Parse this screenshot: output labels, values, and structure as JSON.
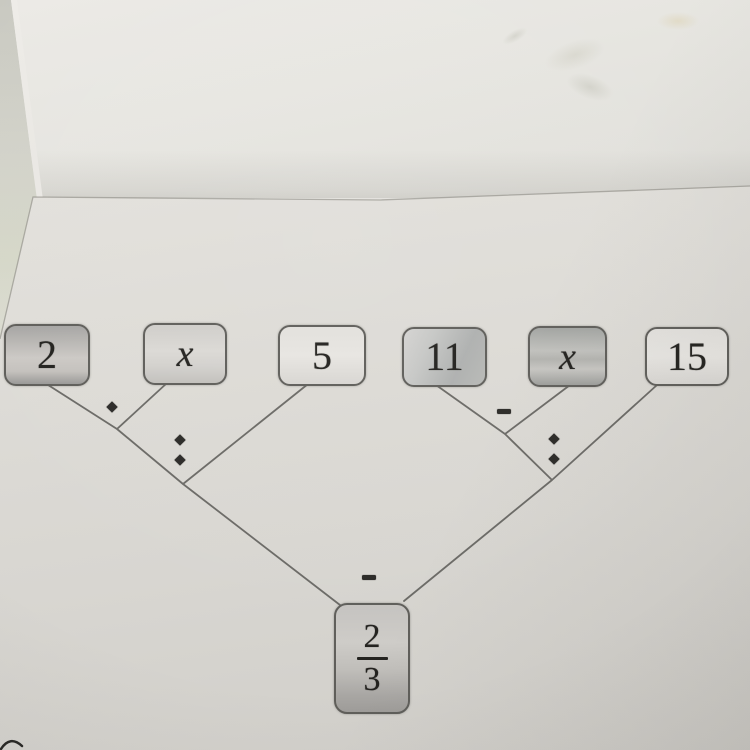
{
  "tree": {
    "leaves": [
      {
        "label": "2"
      },
      {
        "label": "x"
      },
      {
        "label": "5"
      },
      {
        "label": "11"
      },
      {
        "label": "x"
      },
      {
        "label": "15"
      }
    ],
    "operators": [
      {
        "symbol": "·",
        "operation": "multiply",
        "joins": [
          "2",
          "x"
        ]
      },
      {
        "symbol": ":",
        "operation": "divide",
        "joins": [
          "2 · x",
          "5"
        ]
      },
      {
        "symbol": "-",
        "operation": "subtract",
        "joins": [
          "11",
          "x"
        ]
      },
      {
        "symbol": ":",
        "operation": "divide",
        "joins": [
          "11 - x",
          "15"
        ]
      },
      {
        "symbol": "-",
        "operation": "subtract",
        "joins": [
          "(2 · x) : 5",
          "(11 - x) : 15"
        ]
      }
    ],
    "result": {
      "numerator": "2",
      "denominator": "3"
    }
  },
  "colors": {
    "paper": "#dcdad5",
    "connector_line": "#6b6a66",
    "box_border": "#5f5e5a",
    "ink": "#23221f"
  }
}
